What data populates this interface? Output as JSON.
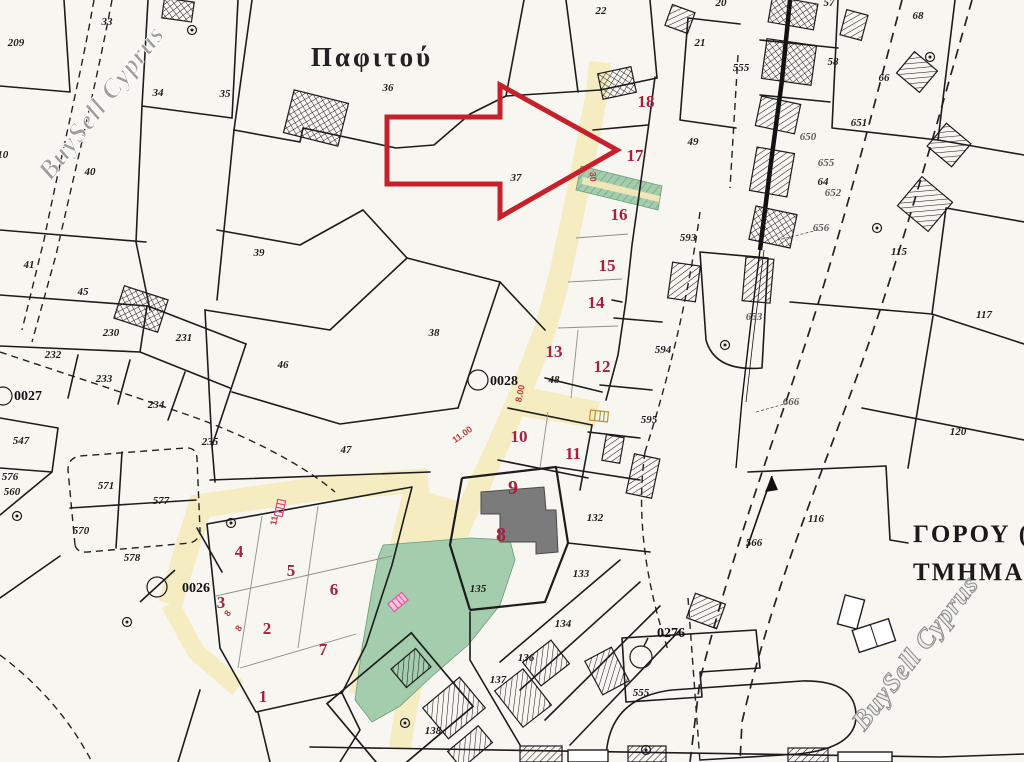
{
  "watermark": "BuySell Cyprus",
  "locality": "Παφιτού",
  "district": {
    "line1": "ΓΟΡΟΥ  (3",
    "line2": "ΤΜΗΜΑ 03"
  },
  "plot_numbers": [
    "1",
    "2",
    "3",
    "4",
    "5",
    "6",
    "7",
    "8",
    "9",
    "10",
    "11",
    "12",
    "13",
    "14",
    "15",
    "16",
    "17",
    "18"
  ],
  "survey_refs": [
    "0026",
    "0027",
    "0028",
    "0276"
  ],
  "parcel_labels": [
    "209",
    "210",
    "33",
    "34",
    "35",
    "40",
    "45",
    "41",
    "36",
    "37",
    "22",
    "39",
    "38",
    "46",
    "47",
    "230",
    "231",
    "232",
    "233",
    "234",
    "235",
    "547",
    "576",
    "560",
    "571",
    "577",
    "570",
    "578",
    "20",
    "57",
    "68",
    "21",
    "58",
    "66",
    "555",
    "651",
    "650",
    "49",
    "655",
    "64",
    "652",
    "656",
    "593",
    "653",
    "594",
    "595",
    "115",
    "117",
    "120",
    "116",
    "666",
    "566",
    "555",
    "132",
    "133",
    "134",
    "136",
    "137",
    "138",
    "135",
    "48"
  ],
  "dimension_labels": [
    "8.00",
    "11.00",
    "30",
    "8",
    "8",
    "11"
  ],
  "colors": {
    "paper": "#f7f6f1",
    "road_fill": "#f5ecc2",
    "green_fill": "#a3cdad",
    "plot_number": "#a4203d",
    "arrow": "#c8202a",
    "dimension": "#c23b3b",
    "watermark": "#9a9a9a",
    "building_gray": "#7b7b7b"
  }
}
